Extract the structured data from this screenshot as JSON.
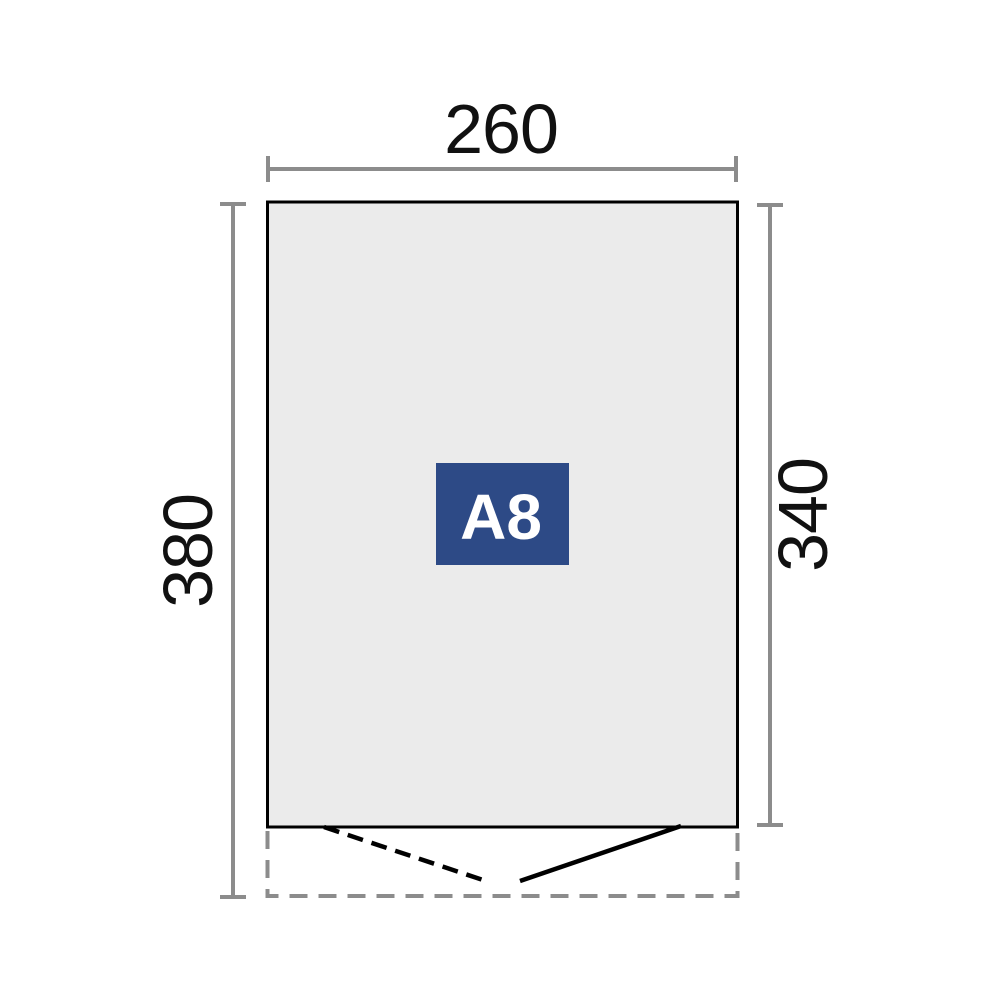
{
  "diagram": {
    "model_label": "A8",
    "dimensions": {
      "top_width": "260",
      "left_height": "380",
      "right_height": "340"
    }
  },
  "colors": {
    "background": "#ffffff",
    "plan_fill": "#ebebeb",
    "plan_border": "#000000",
    "dimension_line": "#8c8c8c",
    "dimension_text": "#111111",
    "door_line": "#000000",
    "door_area_dash": "#8c8c8c",
    "label_badge_bg": "#2d4a86",
    "label_badge_text": "#ffffff"
  }
}
